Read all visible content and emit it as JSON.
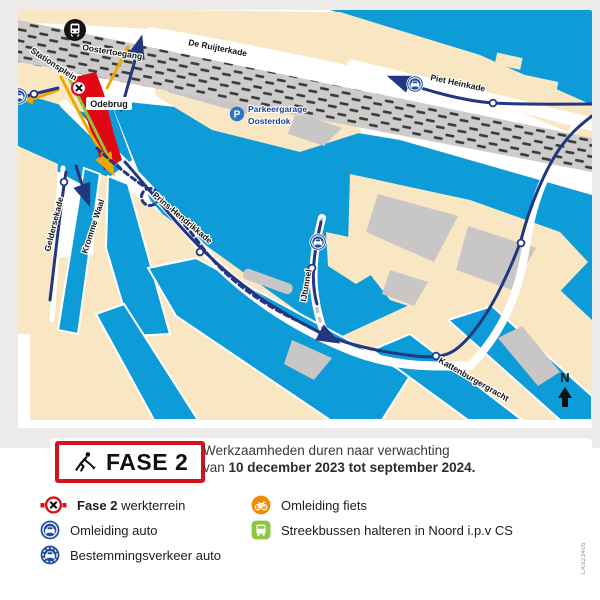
{
  "map": {
    "street_labels": {
      "stationsplein": "Stationsplein",
      "oostertoegang": "Oostertoegang",
      "de_ruijterkade": "De Ruijterkade",
      "piet_heinkade": "Piet Heinkade",
      "prins_hendrikkade": "Prins Hendrikkade",
      "geldersekade": "Geldersekade",
      "kromme_waal": "Kromme Waal",
      "ijtunnel": "IJtunnel",
      "kattenburgergracht": "Kattenburgergracht"
    },
    "bridge_label": "Odebrug",
    "parking": {
      "p": "P",
      "line1": "Parkeergarage",
      "line2": "Oosterdok"
    },
    "north_label": "N",
    "colors": {
      "water": "#0E9CD8",
      "land": "#F9E7C3",
      "building": "#C8C7C5",
      "railway": "#CDCCCA",
      "route_auto": "#233780",
      "route_fiets": "#F0A800",
      "route_bus": "#8DC63F",
      "work_area": "#E30613",
      "icon_blue": "#1C4E9C"
    }
  },
  "phase": {
    "label": "FASE 2"
  },
  "description": {
    "line1": "Werkzaamheden duren naar verwachting",
    "line2_normal": "van ",
    "line2_bold": "10 december 2023 tot september 2024."
  },
  "legend": {
    "work_area_bold": "Fase 2",
    "work_area_rest": " werkterrein",
    "detour_car": "Omleiding auto",
    "destination_car": "Bestemmingsverkeer auto",
    "detour_bike": "Omleiding fiets",
    "bus": "Streekbussen halteren in Noord i.p.v CS"
  },
  "doc_code": "LAS23405"
}
